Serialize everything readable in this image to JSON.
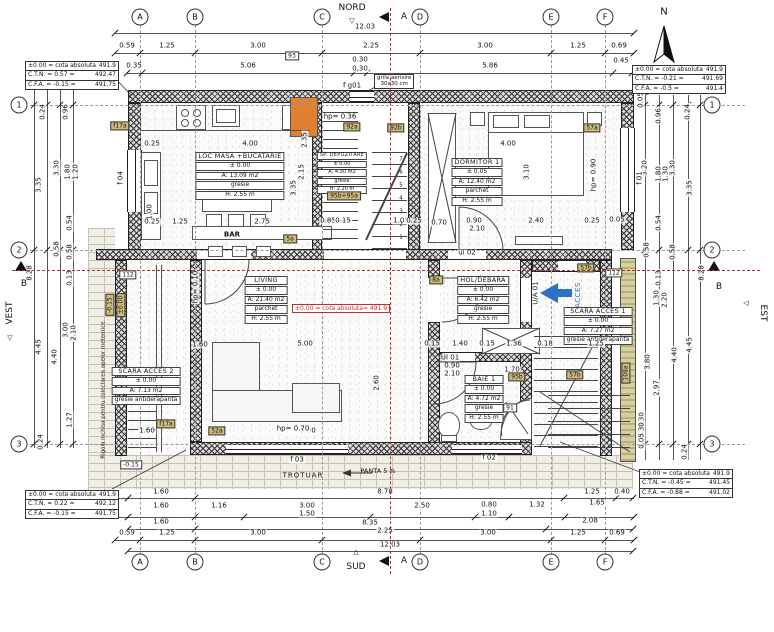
{
  "compass": {
    "north": "NORD",
    "south": "SUD",
    "west": "VEST",
    "east": "EST",
    "n": "N"
  },
  "sections": {
    "a": "A",
    "b": "B"
  },
  "misc": {
    "bar": "BAR",
    "trotuar": "TROTUAR",
    "panta": "PANTA 5 %",
    "acces": "ACCES",
    "grila_1": "grila aerisire",
    "grila_2": "30x30 cm",
    "rigola": "Rigola inchisa pentru colectarea apelor meteorice",
    "red_note": "±0.00 = cota absoluta= 491.9"
  },
  "grid_bubbles": [
    {
      "t": "A",
      "x": 140,
      "y": 17
    },
    {
      "t": "B",
      "x": 195,
      "y": 17
    },
    {
      "t": "C",
      "x": 322,
      "y": 17
    },
    {
      "t": "D",
      "x": 420,
      "y": 17
    },
    {
      "t": "E",
      "x": 551,
      "y": 17
    },
    {
      "t": "F",
      "x": 605,
      "y": 17
    },
    {
      "t": "A",
      "x": 140,
      "y": 562
    },
    {
      "t": "B",
      "x": 195,
      "y": 562
    },
    {
      "t": "C",
      "x": 322,
      "y": 562
    },
    {
      "t": "D",
      "x": 420,
      "y": 562
    },
    {
      "t": "E",
      "x": 551,
      "y": 562
    },
    {
      "t": "F",
      "x": 605,
      "y": 562
    },
    {
      "t": "1",
      "x": 19,
      "y": 105
    },
    {
      "t": "2",
      "x": 19,
      "y": 250
    },
    {
      "t": "3",
      "x": 19,
      "y": 444
    },
    {
      "t": "1",
      "x": 712,
      "y": 105
    },
    {
      "t": "2",
      "x": 712,
      "y": 250
    },
    {
      "t": "3",
      "x": 712,
      "y": 444
    }
  ],
  "ctables": {
    "tl": {
      "rows": [
        {
          "k": "±0.00 = cota absoluta",
          "v": "491.9"
        },
        {
          "k": "C.T.N. = 0.57  =",
          "v": "492.47"
        },
        {
          "k": "C.F.A. = -0.15  =",
          "v": "491.75"
        }
      ]
    },
    "tr": {
      "rows": [
        {
          "k": "±0.00 = cota absoluta",
          "v": "491.9"
        },
        {
          "k": "C.T.N. = -0.21  =",
          "v": "491.69"
        },
        {
          "k": "C.F.A. = -0.5  =",
          "v": "491.4"
        }
      ]
    },
    "bl": {
      "rows": [
        {
          "k": "±0.00 = cota absoluta",
          "v": "491.9"
        },
        {
          "k": "C.T.N. = 0.22  =",
          "v": "492.12"
        },
        {
          "k": "C.F.A. = -0.15  =",
          "v": "491.75"
        }
      ]
    },
    "br": {
      "rows": [
        {
          "k": "±0.00 = cota absoluta",
          "v": "491.9"
        },
        {
          "k": "C.T.N. = -0.45  =",
          "v": "491.45"
        },
        {
          "k": "C.F.A. = -0.88  =",
          "v": "491.02"
        }
      ]
    }
  },
  "rooms": [
    {
      "name": "LOC MASA +BUCATARIE",
      "level": "± 0.00",
      "area": "A: 13.09 m2",
      "finish": "gresie",
      "height": "H: 2.55 m"
    },
    {
      "name": "DORMITOR 1",
      "level": "± 0.05",
      "area": "A: 12.40 m2",
      "finish": "parchet",
      "height": "H: 2.55 m"
    },
    {
      "name": "LIVING",
      "level": "± 0.00",
      "area": "A: 21.40 m2",
      "finish": "parchet",
      "height": "H: 2.55 m"
    },
    {
      "name": "HOL/DEBARA",
      "level": "± 0.00",
      "area": "A: 6.42 m2",
      "finish": "gresie",
      "height": "H: 2.55 m"
    },
    {
      "name": "SCARA ACCES 1",
      "level": "± 0.00",
      "area": "A: 7.27 m2",
      "finish": "gresie antiderapanta",
      "height": ""
    },
    {
      "name": "SCARA ACCES 2",
      "level": "± 0.00",
      "area": "A: 7.13 m2",
      "finish": "gresie antiderapanta",
      "height": ""
    },
    {
      "name": "BAIE 1",
      "level": "± 0.00",
      "area": "A: 4.72 m2",
      "finish": "gresie",
      "height": "H: 2.55 m"
    },
    {
      "name": "SP. DEPOZITARE",
      "level": "± 0.00",
      "area": "A: 4.30 m2",
      "finish": "gresie",
      "height": "H: 2.20 m"
    }
  ],
  "dims_top": [
    {
      "t": "12.03",
      "x": 365,
      "y": 27
    },
    {
      "t": "0.59",
      "x": 127,
      "y": 46
    },
    {
      "t": "1.25",
      "x": 167,
      "y": 46
    },
    {
      "t": "3.00",
      "x": 258,
      "y": 46
    },
    {
      "t": "2.25",
      "x": 371,
      "y": 46
    },
    {
      "t": "3.00",
      "x": 485,
      "y": 46
    },
    {
      "t": "1.25",
      "x": 578,
      "y": 46
    },
    {
      "t": "0.69",
      "x": 619,
      "y": 46
    },
    {
      "t": "0.35",
      "x": 134,
      "y": 66
    },
    {
      "t": "5.06",
      "x": 248,
      "y": 66
    },
    {
      "t": "0.30",
      "x": 360,
      "y": 60
    },
    {
      "t": "0,30",
      "x": 360,
      "y": 69
    },
    {
      "t": "5.86",
      "x": 490,
      "y": 66
    },
    {
      "t": "0.45",
      "x": 621,
      "y": 61
    }
  ],
  "dims_bottom": [
    {
      "t": "1.60",
      "x": 161,
      "y": 492
    },
    {
      "t": "8.78",
      "x": 385,
      "y": 492
    },
    {
      "t": "1.25",
      "x": 592,
      "y": 492
    },
    {
      "t": "0.40",
      "x": 622,
      "y": 492
    },
    {
      "t": "1.60",
      "x": 161,
      "y": 506
    },
    {
      "t": "1.16",
      "x": 219,
      "y": 506
    },
    {
      "t": "3.00",
      "x": 307,
      "y": 506
    },
    {
      "t": "1.50",
      "x": 307,
      "y": 514
    },
    {
      "t": "2.50",
      "x": 422,
      "y": 506
    },
    {
      "t": "0.80",
      "x": 489,
      "y": 505
    },
    {
      "t": "1.10",
      "x": 489,
      "y": 514
    },
    {
      "t": "1.32",
      "x": 537,
      "y": 505
    },
    {
      "t": "1.65",
      "x": 597,
      "y": 503
    },
    {
      "t": "1.60",
      "x": 161,
      "y": 522
    },
    {
      "t": "8.35",
      "x": 370,
      "y": 523
    },
    {
      "t": "2.08",
      "x": 590,
      "y": 521
    },
    {
      "t": "0.59",
      "x": 127,
      "y": 533
    },
    {
      "t": "1.25",
      "x": 167,
      "y": 533
    },
    {
      "t": "3.00",
      "x": 258,
      "y": 533
    },
    {
      "t": "2.25",
      "x": 385,
      "y": 531
    },
    {
      "t": "3.00",
      "x": 488,
      "y": 533
    },
    {
      "t": "1.25",
      "x": 578,
      "y": 533
    },
    {
      "t": "0.69",
      "x": 617,
      "y": 533
    },
    {
      "t": "12.03",
      "x": 390,
      "y": 545
    }
  ],
  "dims_left": [
    {
      "t": "0.24",
      "x": 43,
      "y": 112,
      "r": 1
    },
    {
      "t": "0.96",
      "x": 66,
      "y": 112,
      "r": 1
    },
    {
      "t": "3.35",
      "x": 39,
      "y": 185,
      "r": 1
    },
    {
      "t": "3.30",
      "x": 57,
      "y": 168,
      "r": 1
    },
    {
      "t": "1.80",
      "x": 68,
      "y": 172,
      "r": 1
    },
    {
      "t": "1.20",
      "x": 76,
      "y": 172,
      "r": 1
    },
    {
      "t": "0.54",
      "x": 70,
      "y": 223,
      "r": 1
    },
    {
      "t": "0.58",
      "x": 57,
      "y": 249,
      "r": 1
    },
    {
      "t": "0.58",
      "x": 70,
      "y": 252,
      "r": 1
    },
    {
      "t": "0.13",
      "x": 70,
      "y": 278,
      "r": 1
    },
    {
      "t": "8.28",
      "x": 30,
      "y": 273,
      "r": 1
    },
    {
      "t": "3.00",
      "x": 66,
      "y": 330,
      "r": 1
    },
    {
      "t": "2.10",
      "x": 74,
      "y": 333,
      "r": 1
    },
    {
      "t": "4.45",
      "x": 39,
      "y": 347,
      "r": 1
    },
    {
      "t": "4.40",
      "x": 55,
      "y": 357,
      "r": 1
    },
    {
      "t": "1.27",
      "x": 70,
      "y": 420,
      "r": 1
    },
    {
      "t": "0.24",
      "x": 41,
      "y": 442,
      "r": 1
    }
  ],
  "dims_right": [
    {
      "t": "0.05",
      "x": 641,
      "y": 100,
      "r": 1
    },
    {
      "t": "0.96",
      "x": 659,
      "y": 116,
      "r": 1
    },
    {
      "t": "0.24",
      "x": 688,
      "y": 112,
      "r": 1
    },
    {
      "t": "3.20",
      "x": 645,
      "y": 168,
      "r": 1
    },
    {
      "t": "1.80",
      "x": 659,
      "y": 174,
      "r": 1
    },
    {
      "t": "1.30",
      "x": 666,
      "y": 174,
      "r": 1
    },
    {
      "t": "3.30",
      "x": 673,
      "y": 168,
      "r": 1
    },
    {
      "t": "3.35",
      "x": 690,
      "y": 188,
      "r": 1
    },
    {
      "t": "0.54",
      "x": 659,
      "y": 223,
      "r": 1
    },
    {
      "t": "0.58",
      "x": 647,
      "y": 250,
      "r": 1
    },
    {
      "t": "0.58",
      "x": 673,
      "y": 252,
      "r": 1
    },
    {
      "t": "0.13",
      "x": 659,
      "y": 278,
      "r": 1
    },
    {
      "t": "8.28",
      "x": 702,
      "y": 273,
      "r": 1
    },
    {
      "t": "1.30",
      "x": 657,
      "y": 298,
      "r": 1
    },
    {
      "t": "2.20",
      "x": 665,
      "y": 300,
      "r": 1
    },
    {
      "t": "3.80",
      "x": 648,
      "y": 362,
      "r": 1
    },
    {
      "t": "4.45",
      "x": 690,
      "y": 345,
      "r": 1
    },
    {
      "t": "4.40",
      "x": 675,
      "y": 355,
      "r": 1
    },
    {
      "t": "2.97",
      "x": 657,
      "y": 388,
      "r": 1
    },
    {
      "t": "0.30",
      "x": 642,
      "y": 420,
      "r": 1
    },
    {
      "t": "0.30",
      "x": 642,
      "y": 430,
      "r": 1
    },
    {
      "t": "0.05",
      "x": 642,
      "y": 441,
      "r": 1
    },
    {
      "t": "0.24",
      "x": 685,
      "y": 452,
      "r": 1
    }
  ],
  "dims_inner": [
    {
      "t": "0.25",
      "x": 152,
      "y": 144
    },
    {
      "t": "4.00",
      "x": 250,
      "y": 144
    },
    {
      "t": "1.00",
      "x": 150,
      "y": 212,
      "r": 1
    },
    {
      "t": "2.15",
      "x": 302,
      "y": 172,
      "r": 1
    },
    {
      "t": "3.35",
      "x": 294,
      "y": 188,
      "r": 1
    },
    {
      "t": "2.35",
      "x": 305,
      "y": 140,
      "r": 1
    },
    {
      "t": "0.25",
      "x": 152,
      "y": 222
    },
    {
      "t": "1.25",
      "x": 180,
      "y": 222
    },
    {
      "t": "2.75",
      "x": 262,
      "y": 222
    },
    {
      "t": "4.00",
      "x": 508,
      "y": 144
    },
    {
      "t": "3.10",
      "x": 527,
      "y": 172,
      "r": 1
    },
    {
      "t": "0.70",
      "x": 439,
      "y": 223
    },
    {
      "t": "0.90",
      "x": 474,
      "y": 221
    },
    {
      "t": "2.10",
      "x": 477,
      "y": 229
    },
    {
      "t": "2.40",
      "x": 536,
      "y": 221
    },
    {
      "t": "0.25",
      "x": 592,
      "y": 221
    },
    {
      "t": "0.05",
      "x": 617,
      "y": 220
    },
    {
      "t": "hp= 0.90",
      "x": 594,
      "y": 175,
      "r": 1
    },
    {
      "t": "0.85",
      "x": 328,
      "y": 221
    },
    {
      "t": "0.15",
      "x": 343,
      "y": 221
    },
    {
      "t": "1.05",
      "x": 401,
      "y": 221
    },
    {
      "t": "0.25",
      "x": 414,
      "y": 221
    },
    {
      "t": "1.60",
      "x": 200,
      "y": 345
    },
    {
      "t": "5.00",
      "x": 305,
      "y": 344
    },
    {
      "t": "5.00",
      "x": 308,
      "y": 431
    },
    {
      "t": "2.60",
      "x": 377,
      "y": 383,
      "r": 1
    },
    {
      "t": "1.60",
      "x": 147,
      "y": 431
    },
    {
      "t": "hp= 0.70",
      "x": 293,
      "y": 429
    },
    {
      "t": "0.15",
      "x": 432,
      "y": 344
    },
    {
      "t": "1.40",
      "x": 460,
      "y": 344
    },
    {
      "t": "0.15",
      "x": 487,
      "y": 344
    },
    {
      "t": "1.36",
      "x": 514,
      "y": 344
    },
    {
      "t": "0.18",
      "x": 545,
      "y": 344
    },
    {
      "t": "1.25",
      "x": 596,
      "y": 344
    },
    {
      "t": "0.90",
      "x": 452,
      "y": 366
    },
    {
      "t": "2.10",
      "x": 452,
      "y": 374
    },
    {
      "t": "1.70",
      "x": 512,
      "y": 370
    },
    {
      "t": "f 04",
      "x": 121,
      "y": 178,
      "r": 1
    },
    {
      "t": "f 01",
      "x": 640,
      "y": 178,
      "r": 1
    },
    {
      "t": "f 03",
      "x": 297,
      "y": 460
    },
    {
      "t": "f 02",
      "x": 489,
      "y": 458
    },
    {
      "t": "f g01",
      "x": 352,
      "y": 86
    },
    {
      "t": "ui 02",
      "x": 467,
      "y": 253
    },
    {
      "t": "UI 01",
      "x": 450,
      "y": 358
    },
    {
      "t": "U/A 01",
      "x": 536,
      "y": 293,
      "r": 1
    },
    {
      "t": "hp= 0.36",
      "x": 340,
      "y": 117
    },
    {
      "t": "hp= 0.10",
      "x": 196,
      "y": 287,
      "r": 1
    },
    {
      "t": "7",
      "x": 401,
      "y": 160,
      "cls": "tiny"
    },
    {
      "t": "6",
      "x": 401,
      "y": 173,
      "cls": "tiny"
    },
    {
      "t": "5",
      "x": 401,
      "y": 186,
      "cls": "tiny"
    },
    {
      "t": "4",
      "x": 401,
      "y": 199,
      "cls": "tiny"
    },
    {
      "t": "3",
      "x": 401,
      "y": 212,
      "cls": "tiny"
    },
    {
      "t": "2",
      "x": 401,
      "y": 225,
      "cls": "tiny"
    },
    {
      "t": "1",
      "x": 401,
      "y": 238,
      "cls": "tiny"
    }
  ],
  "tags": [
    {
      "t": "93",
      "x": 292,
      "y": 56,
      "cls": "w"
    },
    {
      "t": "92a",
      "x": 352,
      "y": 127
    },
    {
      "t": "92b",
      "x": 396,
      "y": 128
    },
    {
      "t": "57a",
      "x": 592,
      "y": 128
    },
    {
      "t": "95b+95a",
      "x": 344,
      "y": 196
    },
    {
      "t": "5a",
      "x": 290,
      "y": 239
    },
    {
      "t": "8a",
      "x": 436,
      "y": 280
    },
    {
      "t": "112",
      "x": 128,
      "y": 275,
      "cls": "w"
    },
    {
      "t": "112",
      "x": 614,
      "y": 273,
      "cls": "w"
    },
    {
      "t": "57b",
      "x": 586,
      "y": 268
    },
    {
      "t": "57b",
      "x": 575,
      "y": 375
    },
    {
      "t": "95b",
      "x": 517,
      "y": 377
    },
    {
      "t": "91",
      "x": 510,
      "y": 408,
      "cls": "w"
    },
    {
      "t": "52a",
      "x": 217,
      "y": 431
    },
    {
      "t": "f17a",
      "x": 120,
      "y": 126
    },
    {
      "t": "f17a",
      "x": 166,
      "y": 424
    },
    {
      "t": "-0.15",
      "x": 131,
      "y": 465,
      "cls": "w"
    },
    {
      "t": "-0.15",
      "x": 110,
      "y": 305,
      "r": 1
    },
    {
      "t": "±0.00",
      "x": 121,
      "y": 305,
      "r": 1
    },
    {
      "t": "108a",
      "x": 626,
      "y": 373,
      "r": 1
    }
  ]
}
